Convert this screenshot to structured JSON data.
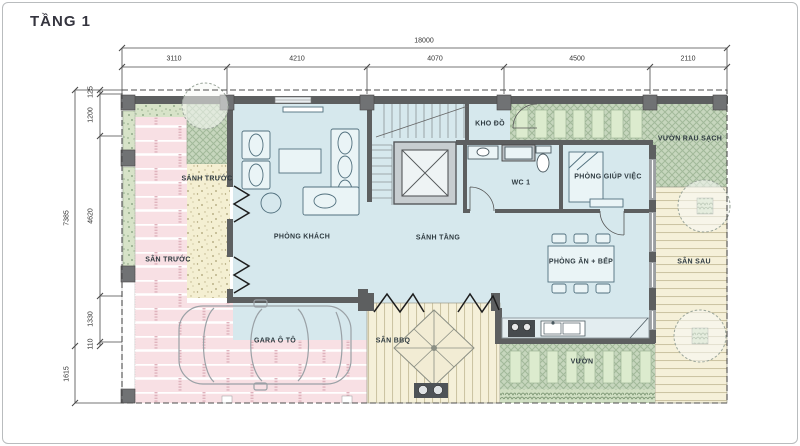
{
  "title": "TẦNG 1",
  "dimensions": {
    "top": {
      "total": "18000",
      "segments": [
        "3110",
        "4210",
        "4070",
        "4500",
        "2110"
      ]
    },
    "left": {
      "total_upper": "7385",
      "total_lower": "1615",
      "segments": [
        "125",
        "1200",
        "4620",
        "1330",
        "110"
      ]
    }
  },
  "rooms": {
    "phong_khach": "PHÒNG KHÁCH",
    "sanh_tang": "SẢNH TẦNG",
    "sanh_truoc": "SẢNH TRƯỚC",
    "san_truoc": "SÂN TRƯỚC",
    "kho_do": "KHO ĐỒ",
    "wc1": "WC 1",
    "phong_giup_viec": "PHÒNG GIÚP VIỆC",
    "vuon_rau_sach": "VƯỜN RAU SẠCH",
    "phong_an_bep": "PHÒNG ĂN + BẾP",
    "san_sau": "SÂN SAU",
    "gara_oto": "GARA Ô TÔ",
    "san_bbq": "SÂN BBQ",
    "vuon": "VƯỜN"
  },
  "colors": {
    "floor": "#d6e8ed",
    "brick": "#f8e0e4",
    "path": "#f4efd2",
    "garden": "#c6d6bd",
    "deck": "#f5f0d9",
    "wall": "#5d5f60"
  }
}
